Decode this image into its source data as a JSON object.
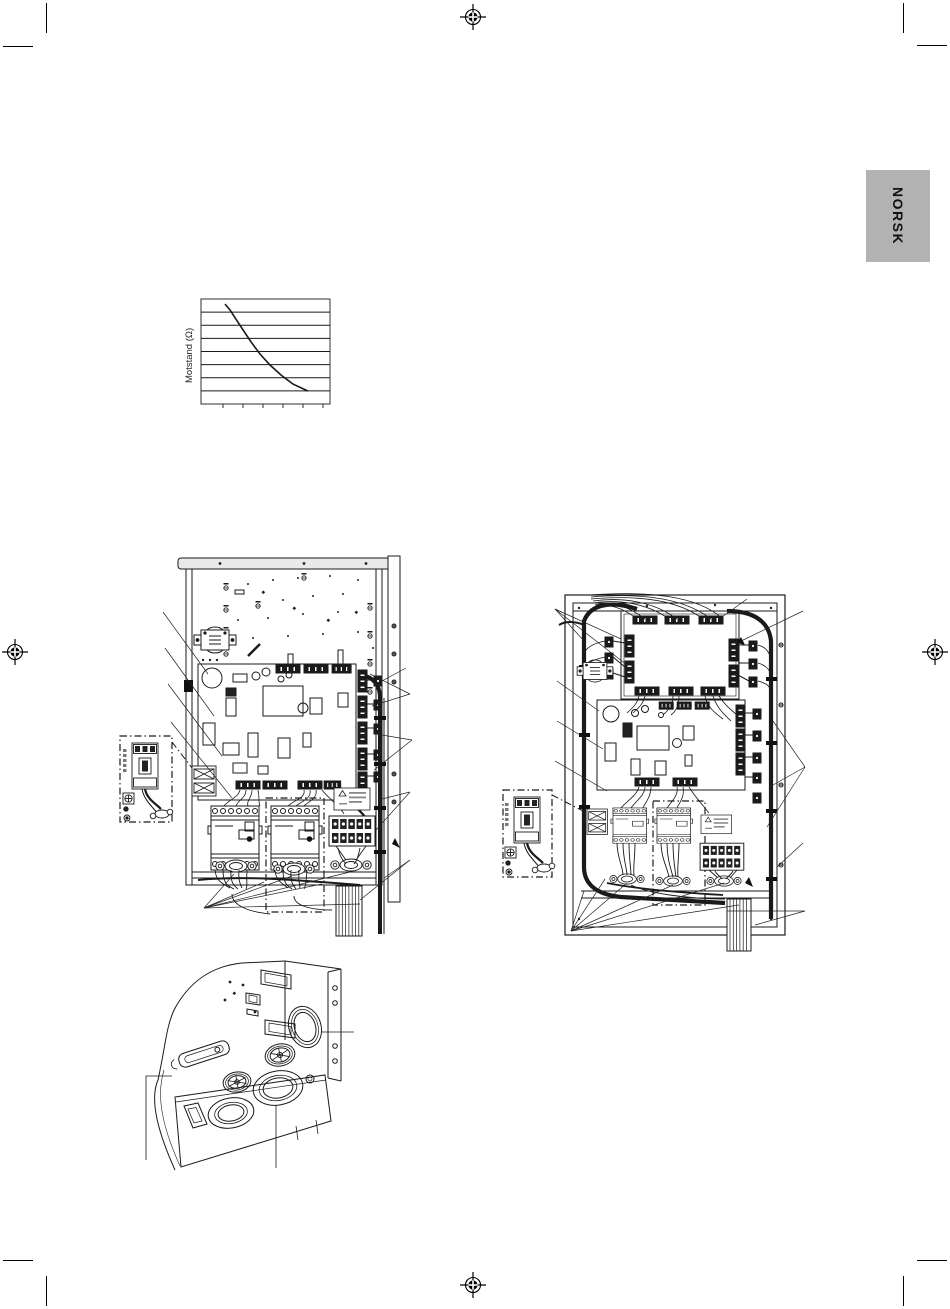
{
  "page": {
    "width": 950,
    "height": 1309,
    "background": "#ffffff",
    "kind": "printed-manual-page"
  },
  "print_marks": {
    "crop_corners": [
      "top-left",
      "top-right",
      "bottom-left",
      "bottom-right"
    ],
    "registration": [
      "top-center",
      "left-middle",
      "right-middle",
      "bottom-center"
    ]
  },
  "language_tab": {
    "label": "NORSK",
    "background": "#b2b2b2",
    "text_color": "#111111"
  },
  "chart_data": {
    "type": "line",
    "title": "",
    "xlabel": "",
    "ylabel": "Motstand (Ω)",
    "x_tick_labels": [],
    "y_tick_labels": [],
    "gridlines": "horizontal",
    "gridline_count": 9,
    "x_tick_count": 6,
    "curve_shape": "exponential-decay",
    "points_pct": [
      [
        18.6,
        4.8
      ],
      [
        22.5,
        10.5
      ],
      [
        27,
        19
      ],
      [
        32.6,
        29.5
      ],
      [
        38.8,
        41
      ],
      [
        45.7,
        52.4
      ],
      [
        53.5,
        62.9
      ],
      [
        62,
        72.4
      ],
      [
        71.3,
        81
      ],
      [
        82.9,
        87.6
      ]
    ],
    "line_color": "#1a1a1a"
  },
  "figures": {
    "left_diagram": "control-cabinet-wiring-view-a",
    "right_diagram": "control-cabinet-wiring-view-b",
    "bottom_diagram": "cable-entry-panel-with-grommets"
  }
}
